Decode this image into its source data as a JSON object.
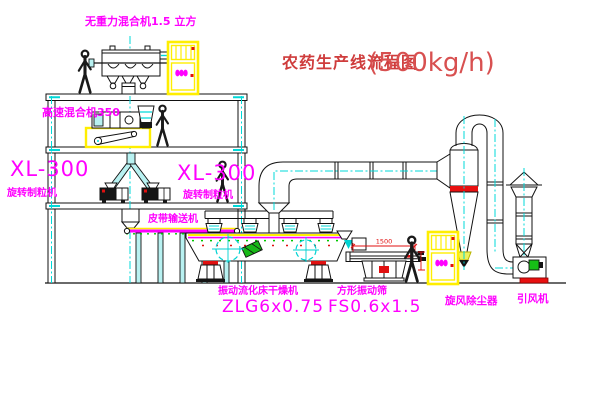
{
  "title": {
    "name_zh": "农药生产线流程图",
    "capacity": "(500kg/h)"
  },
  "labels": {
    "gravity_mixer": "无重力混合机1.5 立方",
    "high_speed_mixer": "高速混合机350",
    "granulator_left_model": "XL-300",
    "granulator_left_name": "旋转制粒机",
    "granulator_mid_model": "XL-300",
    "granulator_mid_name": "旋转制粒机",
    "belt_conveyor": "皮带输送机",
    "dryer_name": "振动流化床干燥机",
    "dryer_model": "ZLG6x0.75",
    "screen_name": "方形振动筛",
    "screen_model": "FS0.6x1.5",
    "cyclone_name": "旋风除尘器",
    "fan_name": "引风机"
  },
  "dimensions": {
    "screen_length": "1500",
    "screen_height": "340"
  },
  "colors": {
    "line": "#111111",
    "centerline_cyan": "#00d9d9",
    "label_magenta": "#ff00ff",
    "equipment_yellow": "#ffee00",
    "status_red": "#e01010",
    "title_red": "#cf3c3c",
    "machine_green": "#18b818"
  }
}
